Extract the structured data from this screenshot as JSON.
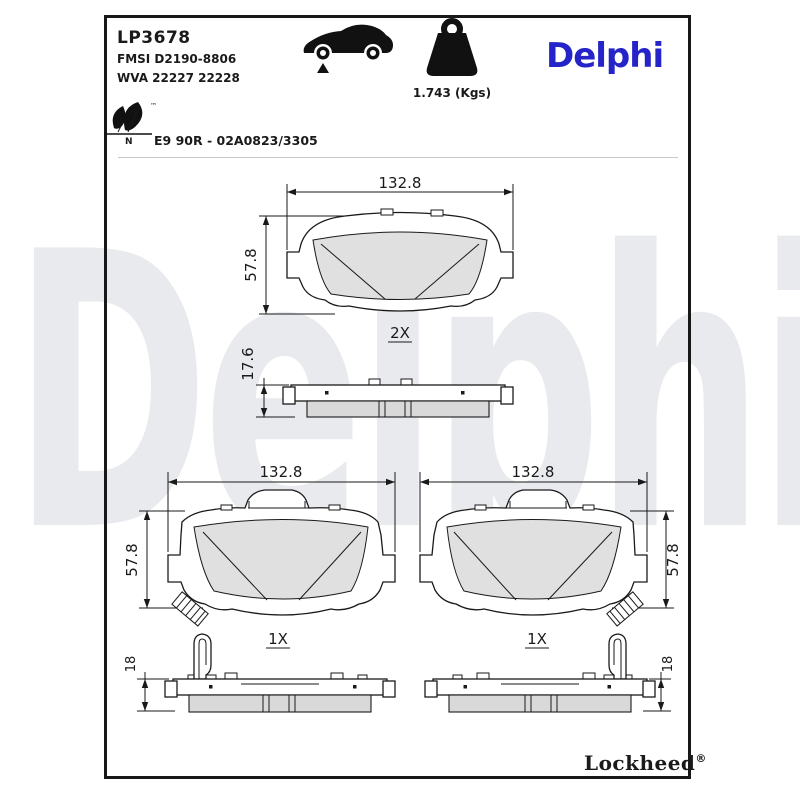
{
  "page": {
    "background": "#ffffff",
    "frame_color": "#181818"
  },
  "header": {
    "part_number": "LP3678",
    "fmsi": "FMSI D2190-8806",
    "wva": "WVA 22227 22228",
    "weight": "1.743 (Kgs)",
    "brand_logo": "Delphi",
    "brand_color": "#2424c8"
  },
  "eco": {
    "letter": "N",
    "trademark": "™"
  },
  "approval": {
    "text": "E9 90R - 02A0823/3305"
  },
  "icons": {
    "vehicle": "car-silhouette-front-axle-marker",
    "weight": "kettlebell-weight",
    "eco": "leaf-pair-eco-mark"
  },
  "watermark": {
    "text": "Delphi",
    "color": "#e9eaee"
  },
  "views": {
    "front_pair": {
      "width": "132.8",
      "height": "57.8",
      "qty": "2X"
    },
    "side_pair": {
      "thickness": "17.6"
    },
    "front_left": {
      "width": "132.8",
      "height": "57.8",
      "qty": "1X"
    },
    "front_right": {
      "width": "132.8",
      "height": "57.8",
      "qty": "1X"
    },
    "side_left": {
      "thickness": "18"
    },
    "side_right": {
      "thickness": "18"
    }
  },
  "footer": {
    "brand": "Lockheed",
    "registered": "®"
  }
}
